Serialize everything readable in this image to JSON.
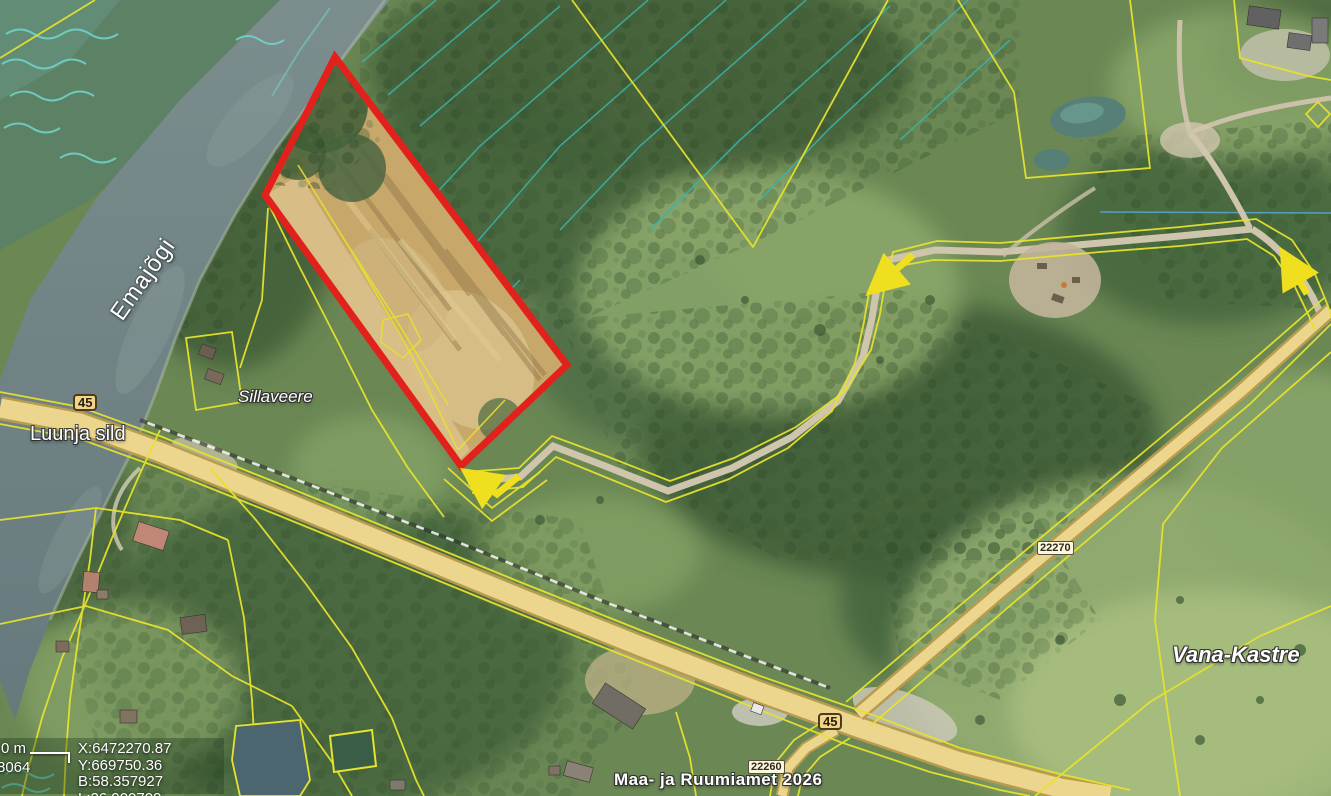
{
  "map": {
    "attribution": "Maa- ja Ruumiamet 2026",
    "place_labels": [
      {
        "id": "emajogi",
        "text": "Emajõgi"
      },
      {
        "id": "luunja-sild",
        "text": "Luunja sild"
      },
      {
        "id": "sillaveere",
        "text": "Sillaveere"
      },
      {
        "id": "vana-kastre",
        "text": "Vana-Kastre"
      }
    ],
    "road_badges": [
      {
        "id": "route-45-bridge",
        "text": "45"
      },
      {
        "id": "route-45-junction",
        "text": "45"
      },
      {
        "id": "route-22270",
        "text": "22270"
      },
      {
        "id": "route-22260",
        "text": "22260"
      }
    ],
    "info_panel": {
      "coords_xy": "X:6472270.87 Y:669750.36",
      "coords_bl": "B:58.357927 L:26.900709",
      "elevation_label": "Kõrgusinfo:",
      "scale_bar_label": "0 m",
      "scale_value": "8064"
    },
    "colors": {
      "selection_red": "#e2211c",
      "cadastral_yellow": "#e6e22e",
      "arrow_yellow": "#f0df1e",
      "ditch_cyan": "#3db3ab",
      "road_fill": "#ecd58c",
      "river": "#75878a"
    }
  }
}
